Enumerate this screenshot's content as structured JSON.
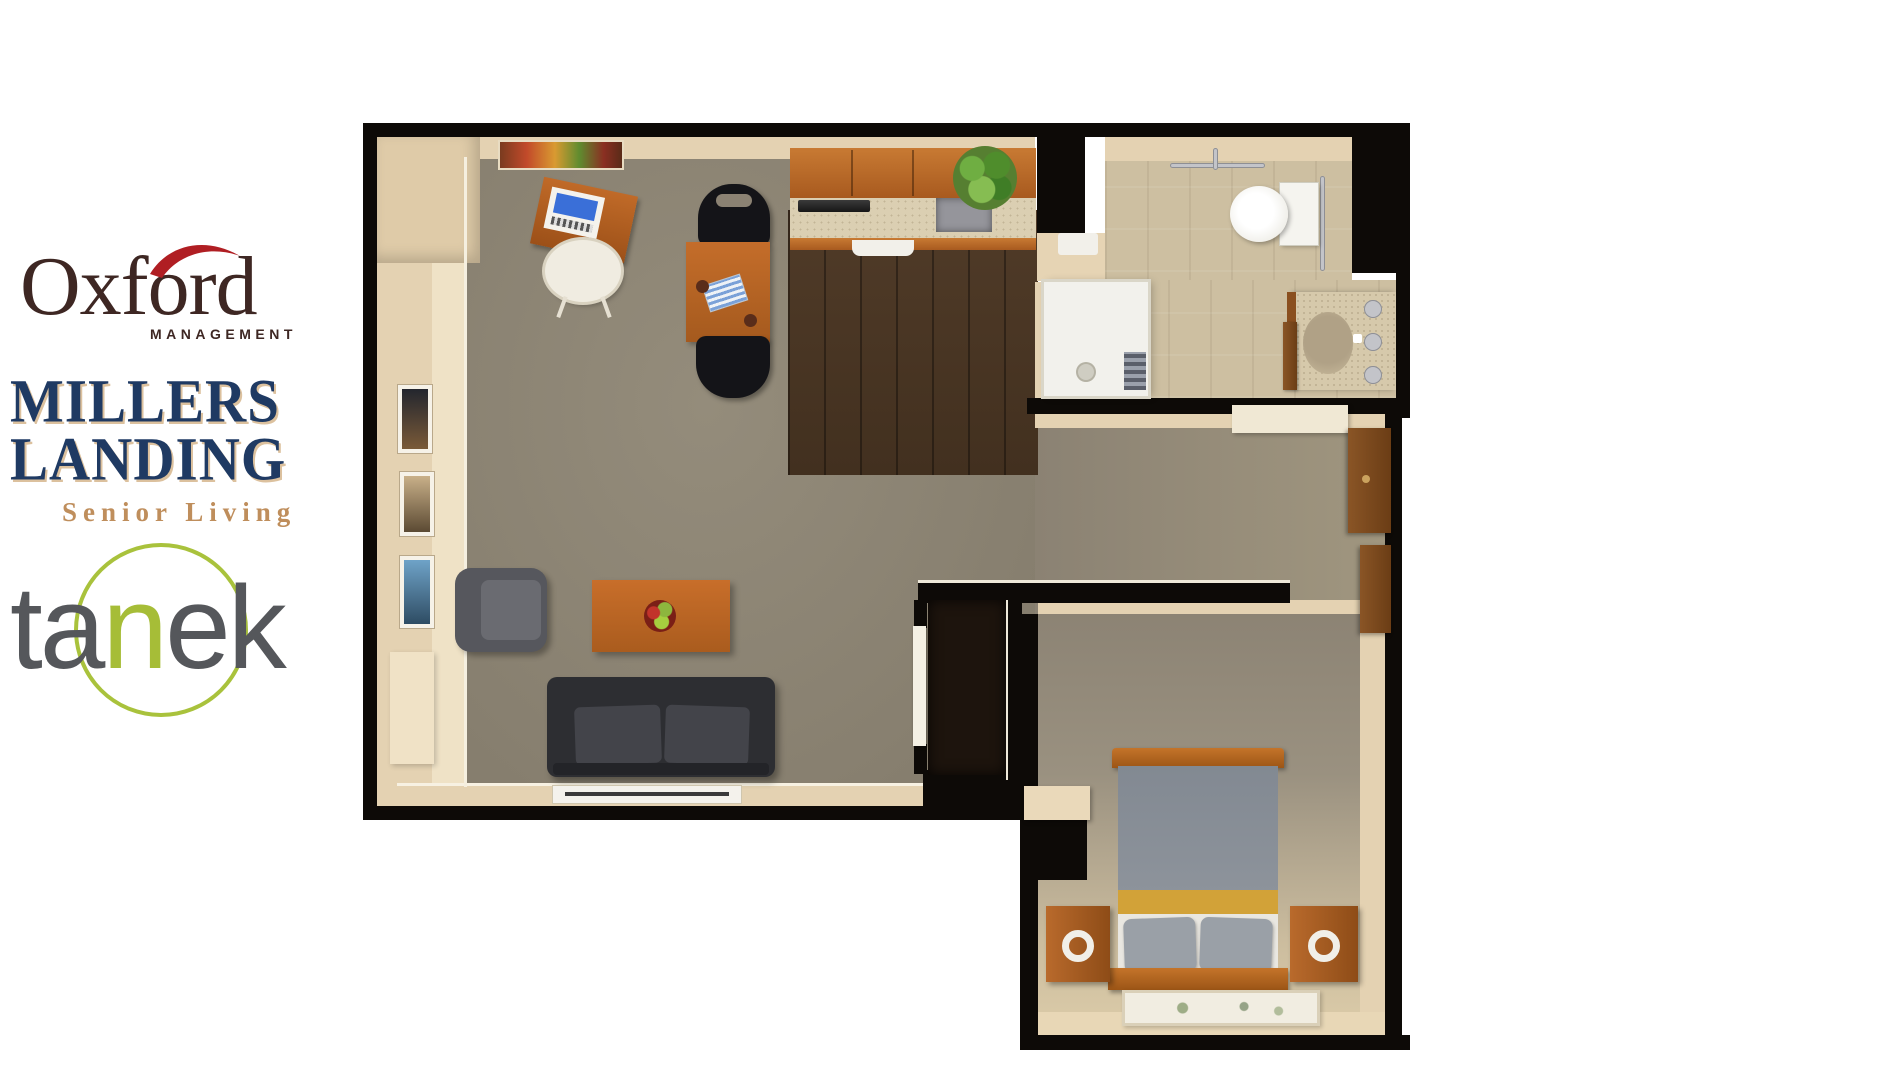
{
  "canvas": {
    "width": 1900,
    "height": 1068,
    "background": "#ffffff"
  },
  "logos": {
    "oxford": {
      "wordmark": "Oxford",
      "subtitle": "MANAGEMENT",
      "text_color": "#3e2723",
      "accent_color": "#b01e23"
    },
    "millers_landing": {
      "line1": "MILLERS",
      "line2": "LANDING",
      "tagline": "Senior Living",
      "text_color": "#1f3a63",
      "tagline_color": "#bf8e5c",
      "outline_color": "#c9a06a"
    },
    "tanek": {
      "part1": "ta",
      "accent_letter": "n",
      "part2": "ek",
      "text_color": "#55575b",
      "accent_color": "#a6bd37",
      "ring_color": "#a9c23c"
    }
  },
  "floorplan": {
    "palette": {
      "wall": "#0d0a07",
      "wall_top": "#e4d2b2",
      "carpet": "#8b8273",
      "wood_floor": "#4c3826",
      "tile": "#cdbfa1",
      "cabinet_wood": "#b4672a",
      "countertop": "#dbcfb2",
      "sofa": "#2d2e32",
      "accent_wood": "#bf6a28",
      "bed_gray": "#878d94",
      "bed_gold": "#d2a238",
      "fixture_white": "#f2f0ea",
      "plant_green": "#5f9e3a"
    },
    "rooms": [
      "living-room",
      "dining-area",
      "kitchen",
      "bathroom",
      "hallway",
      "bedroom",
      "closet"
    ],
    "furniture": [
      "desk",
      "desk-chair",
      "dining-table",
      "dining-chairs",
      "upper-cabinets",
      "countertop",
      "cooktop",
      "kitchen-sink",
      "dishwasher",
      "potted-plant",
      "wall-art",
      "framed-pictures",
      "armchair",
      "coffee-table",
      "fruit-bowl",
      "sofa",
      "tv",
      "shower",
      "shower-mat",
      "toilet",
      "grab-bars",
      "vanity-sink",
      "bathroom-door",
      "closet-door",
      "entry-closet-doors",
      "closet-shelf",
      "bed",
      "headboard",
      "pillows",
      "nightstand-left",
      "nightstand-right",
      "table-lamps",
      "bedroom-rug",
      "bedroom-shelf"
    ]
  }
}
